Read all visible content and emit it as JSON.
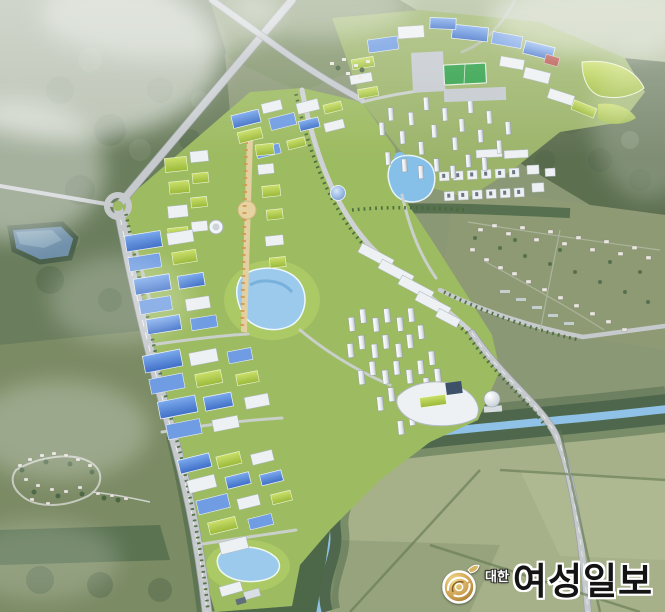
{
  "image": {
    "kind": "aerial-3d-masterplan-rendering",
    "alt": "Bird's-eye 3D rendering of a planned industrial complex new town with blue-roofed factories, green eco-roof offices, white apartment towers, a campus district, ponds, a winding river, farmland and existing villages"
  },
  "watermark": {
    "publisher_prefix": "대한",
    "publisher_name": "여성일보",
    "emblem": "gold-swirl-emblem",
    "colors": {
      "emblem_gold": "#c89a4a",
      "emblem_dark": "#6e4a16",
      "name_text": "#141414",
      "outline": "#ffffff"
    }
  },
  "scene": {
    "palette": {
      "forest": "#5c6f4f",
      "field_olive": "#8e9a74",
      "field_pale": "#a6b18a",
      "complex_green": "#9dbb61",
      "road": "#c6cacd",
      "factory_blue": "#4b7ed2",
      "eco_roof_green": "#b5d04c",
      "water": "#8fc2e6",
      "boulevard_tan": "#e3cf9f"
    },
    "features": [
      "northwest-forest",
      "misty-clouds",
      "highway-x-crossing",
      "roundabout",
      "western-arterial-road",
      "blue-roof-factory-blocks",
      "green-roof-office-blocks",
      "central-boulevard",
      "central-pond",
      "campus-district",
      "sports-field",
      "apartment-cluster-north",
      "apartment-cluster-east",
      "west-reservoir-pond",
      "campus-pond",
      "south-pond",
      "winding-river",
      "existing-village-west",
      "existing-village-east",
      "farmland-fields",
      "dome-building",
      "storage-tanks"
    ]
  }
}
